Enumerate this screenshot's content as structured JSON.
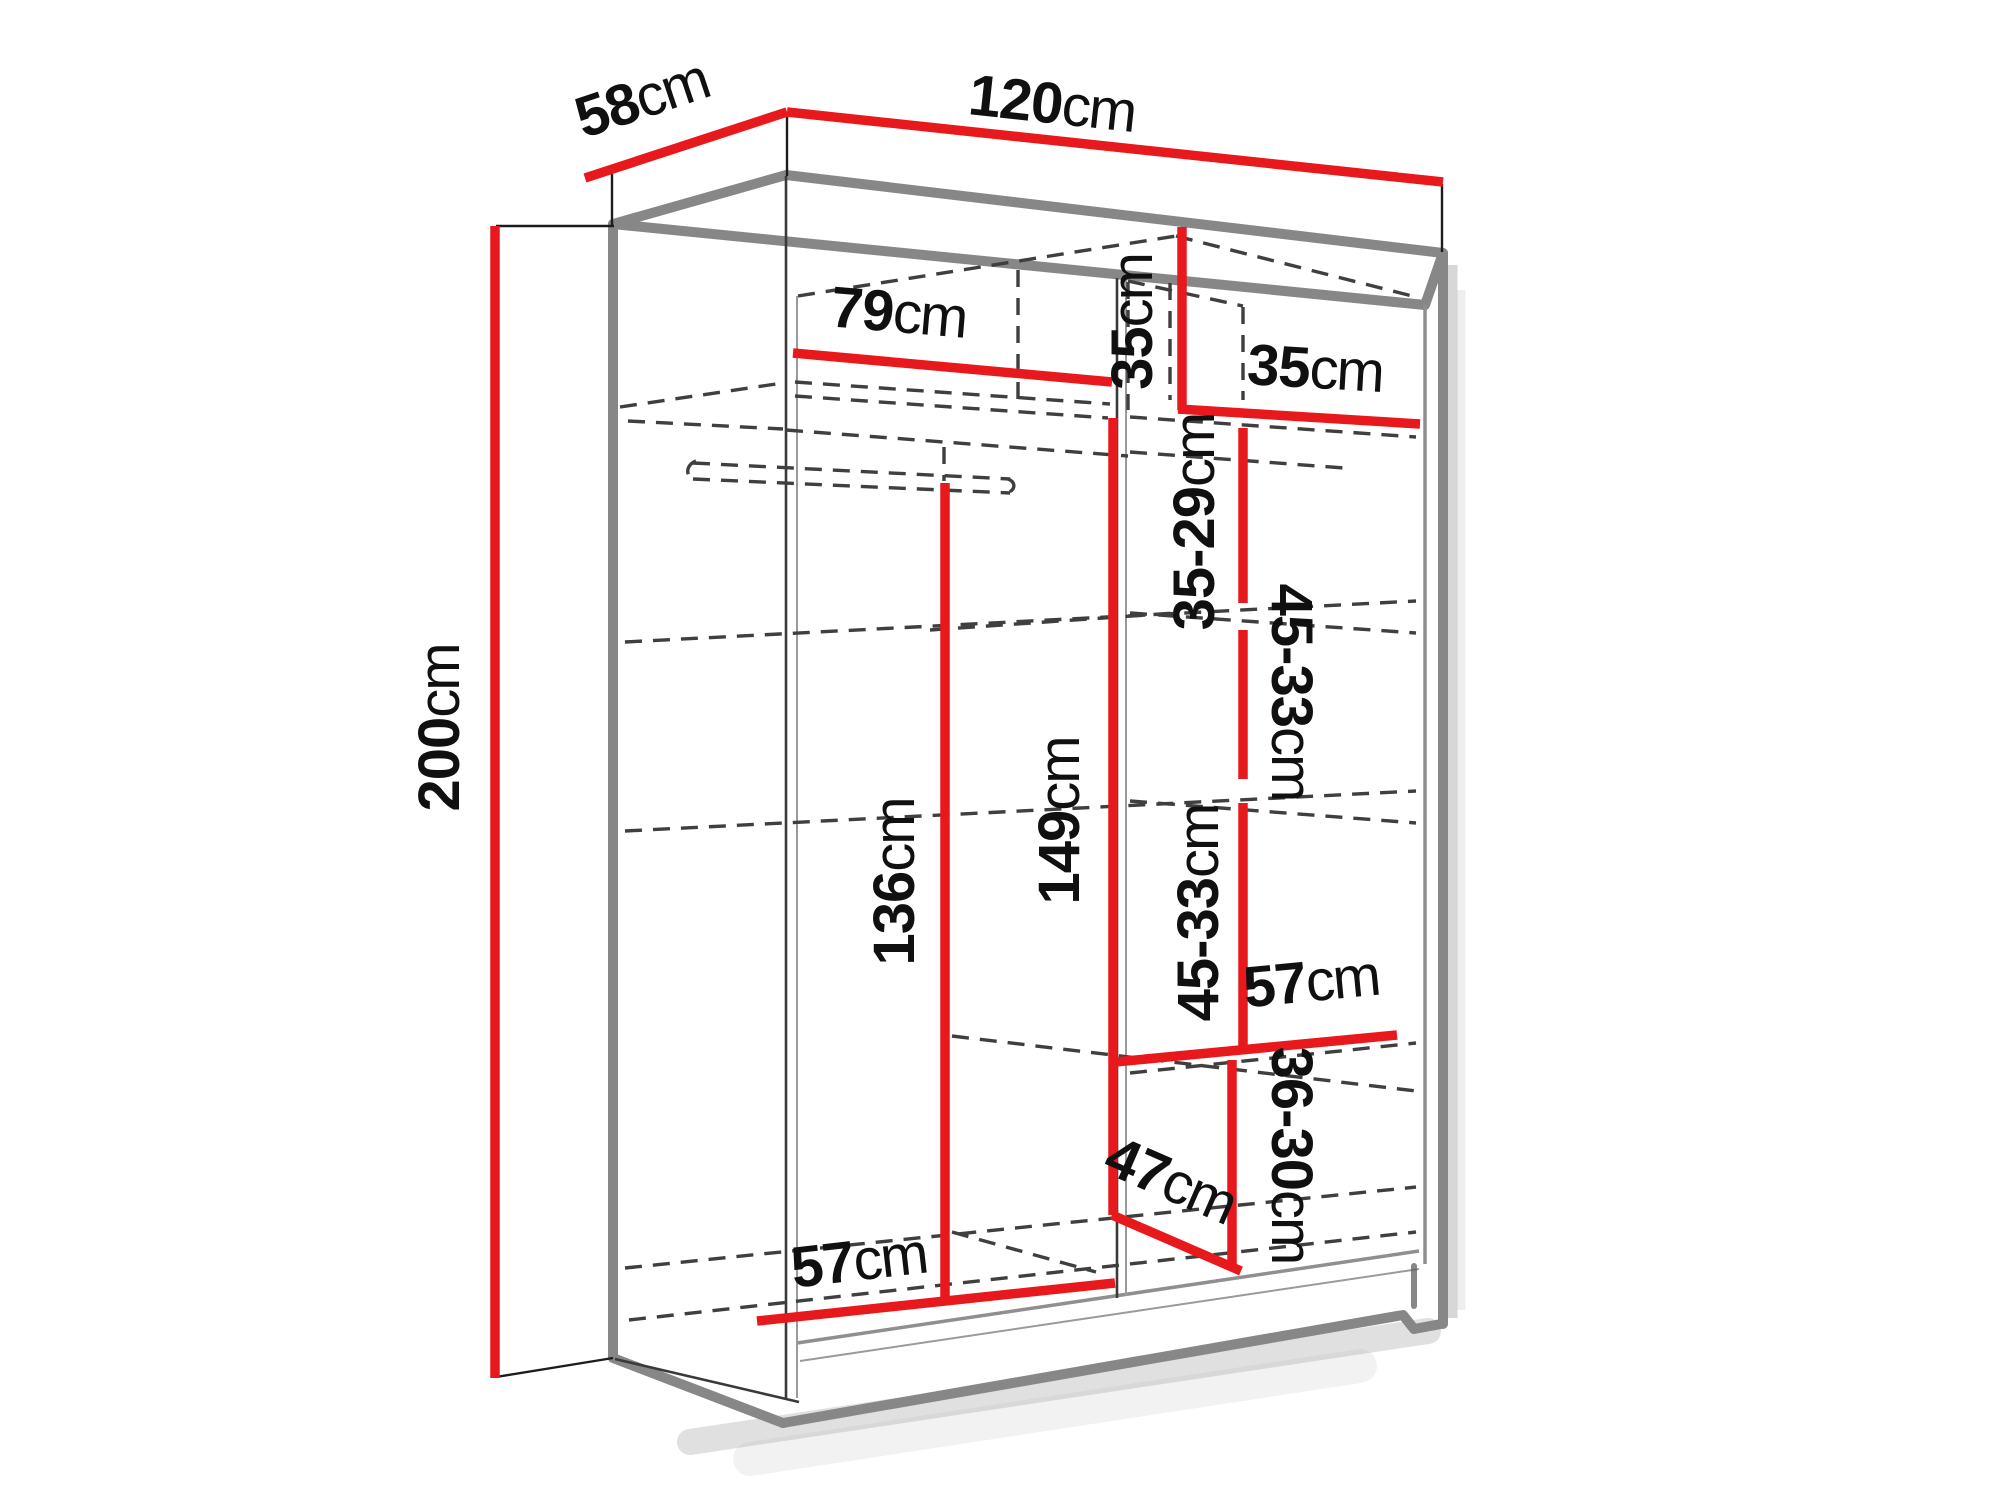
{
  "diagram": {
    "type": "furniture-dimension-diagram",
    "subject": "sliding-door wardrobe interior dimension drawing",
    "unit_suffix": "cm",
    "colors": {
      "dimension_line": "#e8191d",
      "carcass_outline": "#878787",
      "label_text": "#101010",
      "background": "#ffffff"
    },
    "dimensions": [
      {
        "name": "depth-top",
        "value": "58",
        "unit": "cm"
      },
      {
        "name": "width-top",
        "value": "120",
        "unit": "cm"
      },
      {
        "name": "height-left",
        "value": "200",
        "unit": "cm"
      },
      {
        "name": "left-section-width",
        "value": "79",
        "unit": "cm"
      },
      {
        "name": "top-shelf-height-right",
        "value": "35",
        "unit": "cm"
      },
      {
        "name": "top-shelf-width-right",
        "value": "35",
        "unit": "cm"
      },
      {
        "name": "shelf-spacing-upper",
        "value": "35-29",
        "unit": "cm"
      },
      {
        "name": "shelf-spacing-middle",
        "value": "45-33",
        "unit": "cm"
      },
      {
        "name": "shelf-spacing-lower",
        "value": "45-33",
        "unit": "cm"
      },
      {
        "name": "hanging-space-height",
        "value": "136",
        "unit": "cm"
      },
      {
        "name": "middle-section-height",
        "value": "149",
        "unit": "cm"
      },
      {
        "name": "shelf-width-right",
        "value": "57",
        "unit": "cm"
      },
      {
        "name": "bottom-shelf-spacing",
        "value": "36-30",
        "unit": "cm"
      },
      {
        "name": "corner-shelf-depth",
        "value": "47",
        "unit": "cm"
      },
      {
        "name": "bottom-section-width",
        "value": "57",
        "unit": "cm"
      }
    ]
  }
}
